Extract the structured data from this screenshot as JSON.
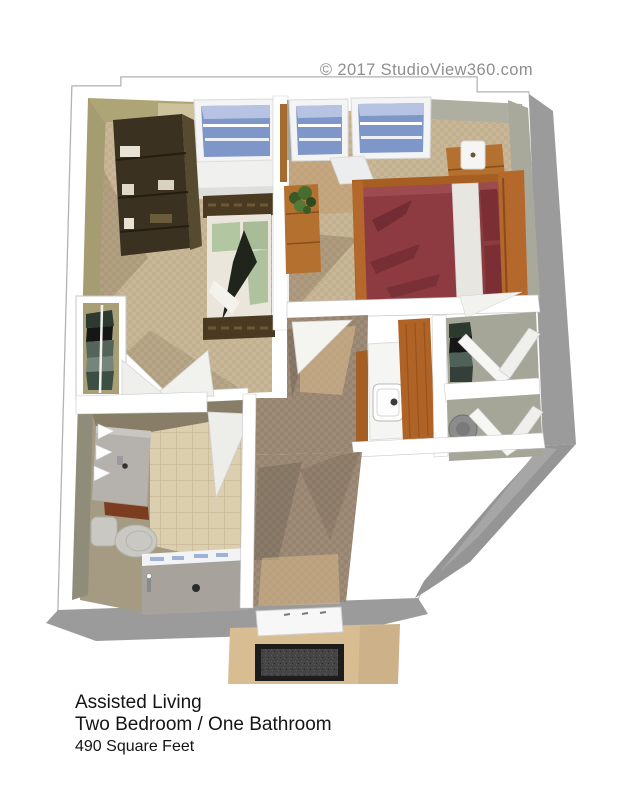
{
  "copyright": "© 2017 StudioView360.com",
  "title": {
    "line1": "Assisted Living",
    "line2": "Two Bedroom / One Bathroom",
    "line3": "490 Square Feet"
  },
  "palette": {
    "copyright_gray": "#8e8e8e",
    "text_black": "#141414",
    "outline_gray": "#a8a8a8",
    "exterior_gray": "#9b9b9b",
    "wall_white": "#ffffff",
    "khaki_wall": "#aea577",
    "sage_wall": "#a8a99b",
    "carpet_tan": "#c8b798",
    "hall_brown": "#9e8b78",
    "tile_beige": "#dccfb0",
    "shower_gray": "#a7a39c",
    "glass_blue": "#7e96c8",
    "bookshelf_brown": "#3a3120",
    "bed1_green": "#b2c6a1",
    "bed2_maroon": "#8d3a41",
    "wood_orange": "#b4702e",
    "mat_dark": "#3c3c3c",
    "stoop_tan": "#d9bd92"
  }
}
